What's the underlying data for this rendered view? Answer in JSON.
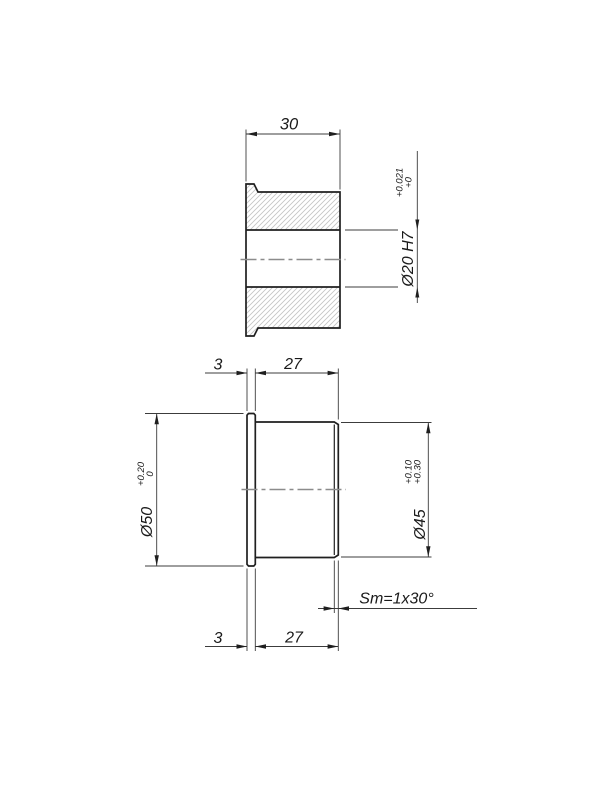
{
  "drawing": {
    "background": "#ffffff",
    "line_color": "#1f1f1f",
    "thin_line_color": "#3c3c3c",
    "hatch_color": "#c5c5c5",
    "centerline_color": "#8c8c8c",
    "text_color": "#1a1a1a",
    "section_view": {
      "overall_length": "30",
      "bore": {
        "label": "Ø20 H7",
        "tol_line1": "+0.021",
        "tol_line2": "+0"
      }
    },
    "side_view": {
      "flange_width_top": "3",
      "body_length_top": "27",
      "flange_od": {
        "label": "Ø50",
        "tol_line1": "+0.20",
        "tol_line2": "0"
      },
      "body_od": {
        "label": "Ø45",
        "tol_line1": "+0.10",
        "tol_line2": "+0.30"
      },
      "chamfer_note": "Sm=1x30°",
      "flange_width_bottom": "3",
      "body_length_bottom": "27"
    }
  }
}
